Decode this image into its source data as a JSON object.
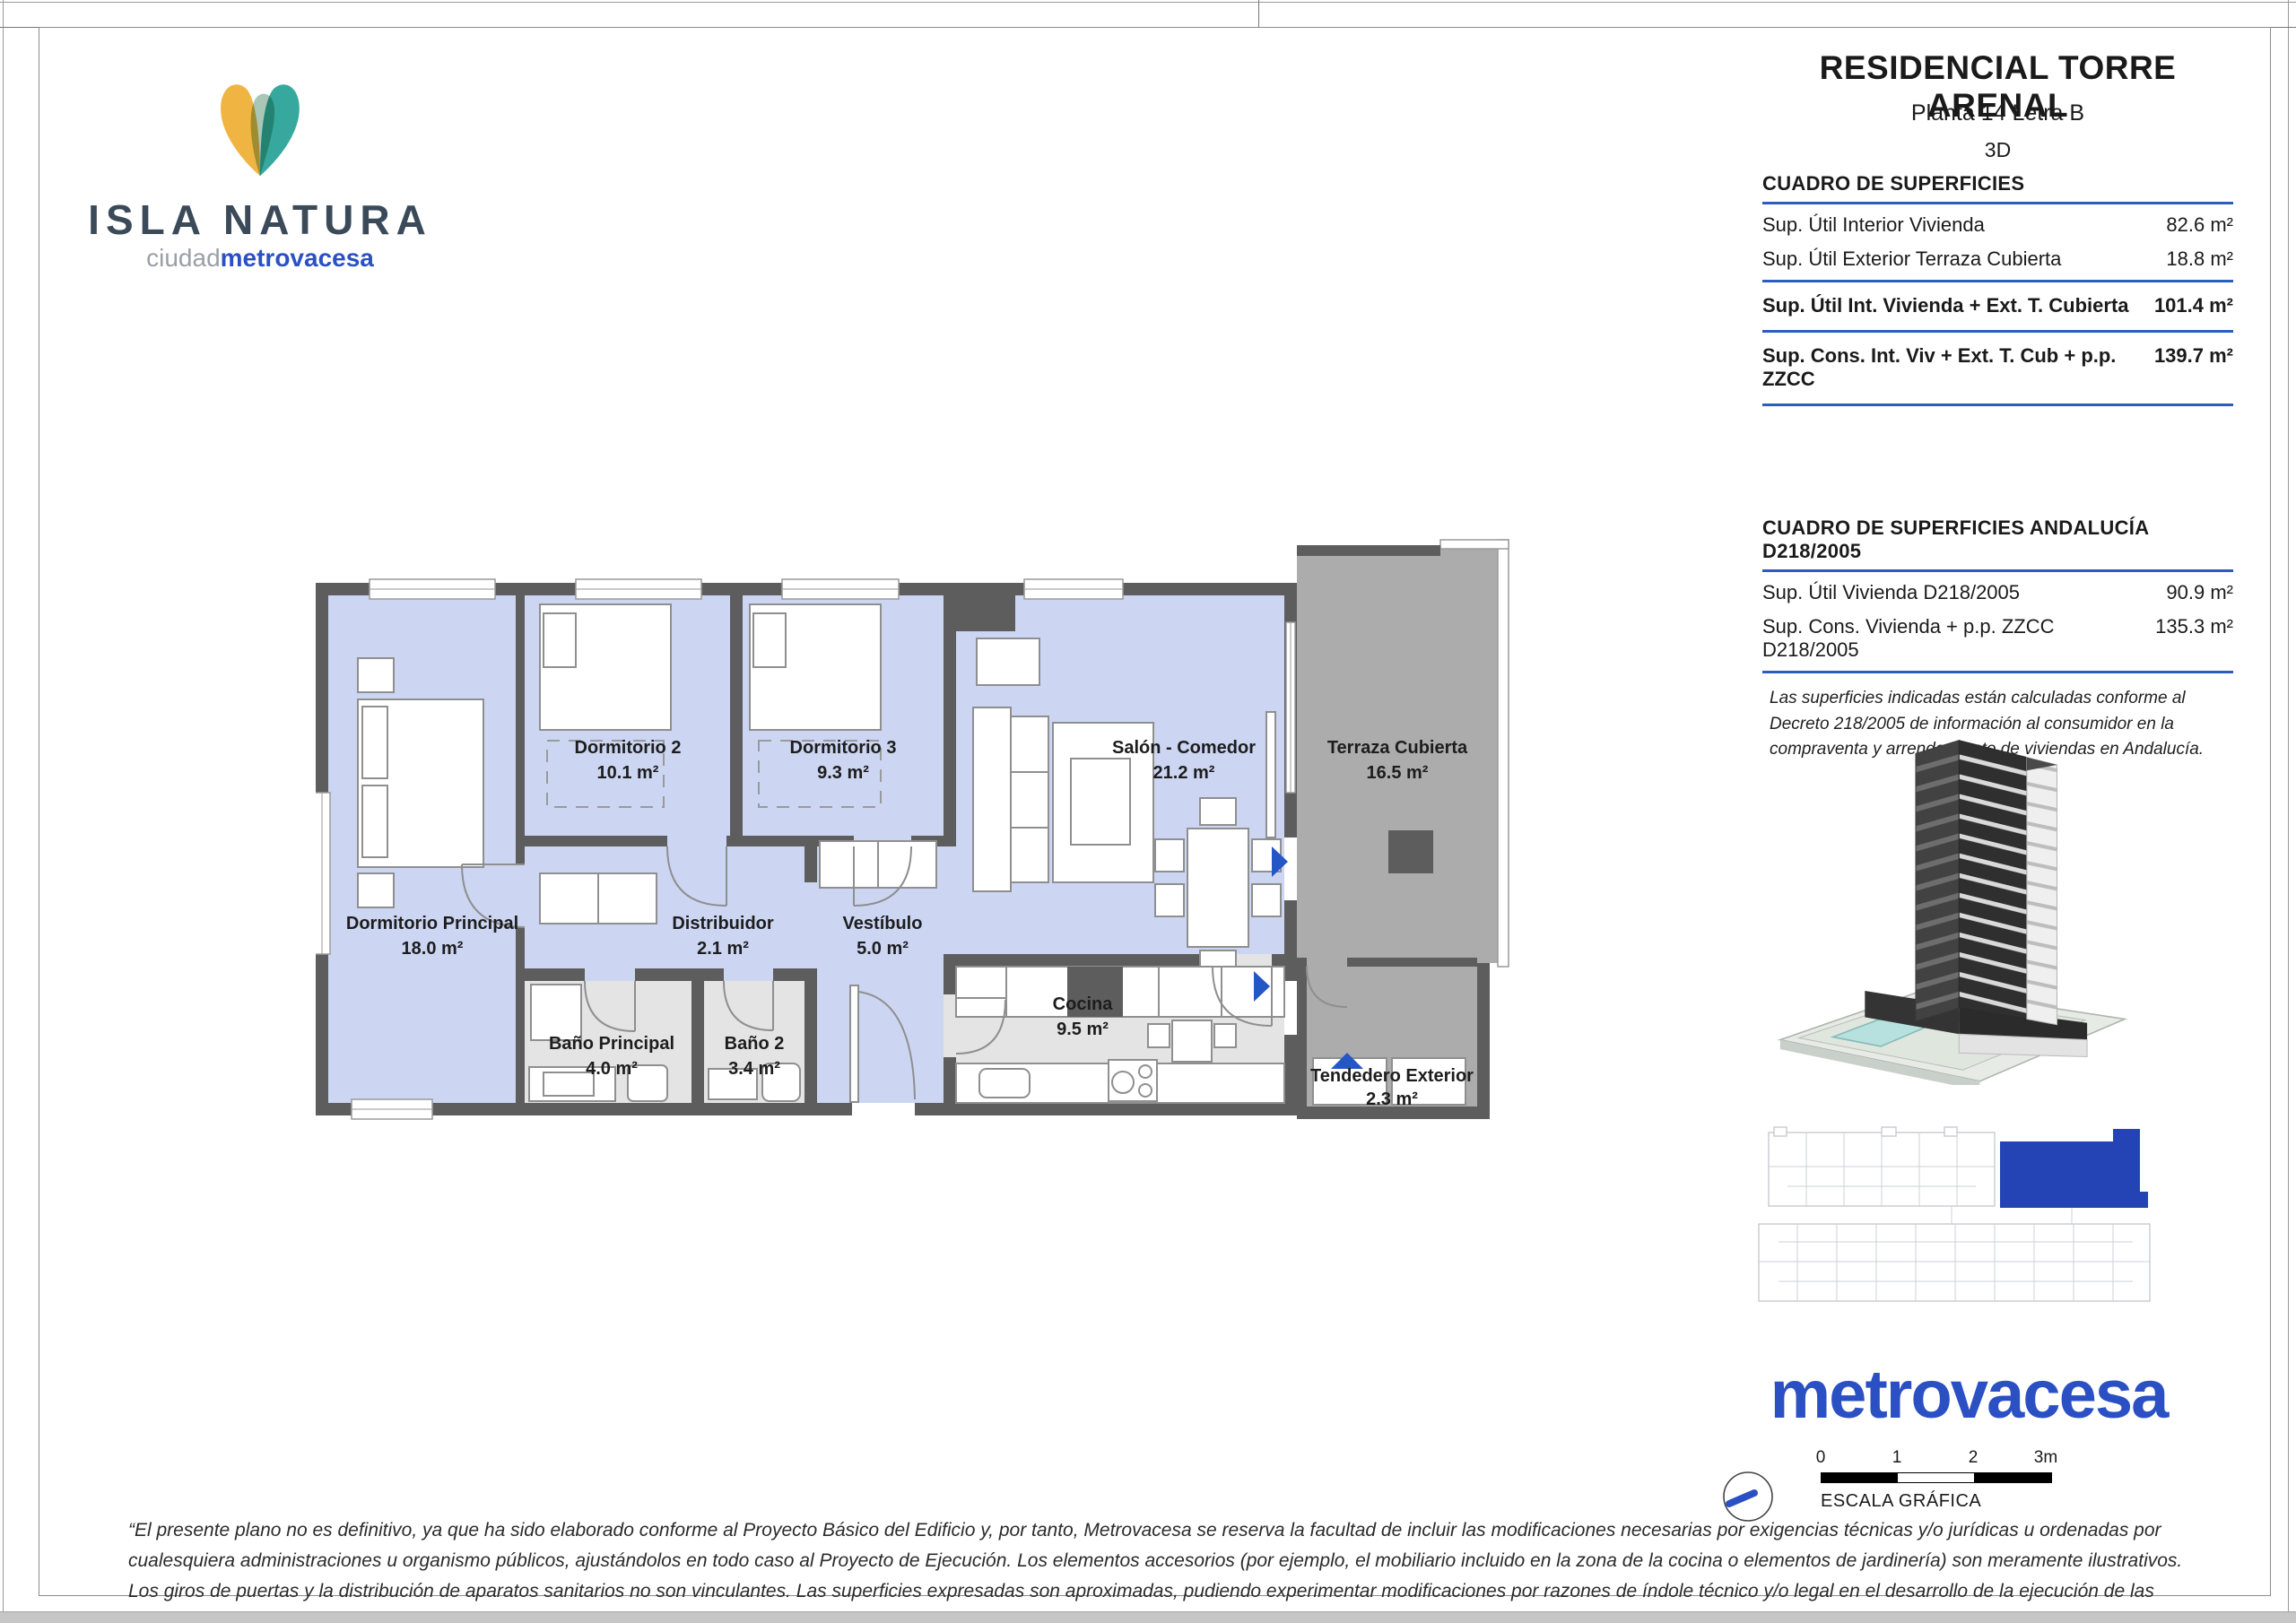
{
  "brand": {
    "name": "ISLA NATURA",
    "sub_gray": "ciudad",
    "sub_blue": "metrovacesa"
  },
  "header": {
    "project": "RESIDENCIAL TORRE ARENAL",
    "unit": "Planta 14 Letra B",
    "view": "3D"
  },
  "surfaces": {
    "title": "CUADRO DE SUPERFICIES",
    "rows": [
      {
        "label": "Sup. Útil Interior Vivienda",
        "value": "82.6 m²"
      },
      {
        "label": "Sup. Útil Exterior Terraza Cubierta",
        "value": "18.8 m²"
      },
      {
        "label": "Sup. Útil Int. Vivienda + Ext. T. Cubierta",
        "value": "101.4 m²"
      },
      {
        "label": "Sup. Cons. Int. Viv + Ext. T. Cub + p.p. ZZCC",
        "value": "139.7 m²"
      }
    ]
  },
  "andalucia": {
    "title": "CUADRO DE SUPERFICIES ANDALUCÍA D218/2005",
    "rows": [
      {
        "label": "Sup. Útil Vivienda D218/2005",
        "value": "90.9 m²"
      },
      {
        "label": "Sup. Cons. Vivienda + p.p. ZZCC D218/2005",
        "value": "135.3 m²"
      }
    ],
    "note": "Las superficies indicadas están calculadas conforme al Decreto 218/2005 de información al consumidor en la compraventa y arrendamiento de viviendas en Andalucía."
  },
  "rooms": [
    {
      "name": "Dormitorio 2",
      "area": "10.1 m²"
    },
    {
      "name": "Dormitorio 3",
      "area": "9.3 m²"
    },
    {
      "name": "Salón - Comedor",
      "area": "21.2 m²"
    },
    {
      "name": "Terraza Cubierta",
      "area": "16.5 m²"
    },
    {
      "name": "Dormitorio Principal",
      "area": "18.0 m²"
    },
    {
      "name": "Distribuidor",
      "area": "2.1 m²"
    },
    {
      "name": "Vestíbulo",
      "area": "5.0 m²"
    },
    {
      "name": "Baño Principal",
      "area": "4.0 m²"
    },
    {
      "name": "Baño 2",
      "area": "3.4 m²"
    },
    {
      "name": "Cocina",
      "area": "9.5 m²"
    },
    {
      "name": "Tendedero Exterior",
      "area": "2.3 m²"
    }
  ],
  "footer": {
    "logo": "metrovacesa",
    "scale_labels": [
      "0",
      "1",
      "2",
      "3m"
    ],
    "scale_caption": "ESCALA GRÁFICA",
    "disclaimer": "“El presente plano no es definitivo, ya que ha sido elaborado conforme al Proyecto Básico del Edificio y, por tanto, Metrovacesa se reserva la facultad de incluir las modificaciones necesarias por exigencias técnicas y/o jurídicas u ordenadas por cualesquiera administraciones u organismo públicos, ajustándolos en todo caso al Proyecto de Ejecución. Los elementos accesorios (por ejemplo, el mobiliario incluido en la zona de la cocina o elementos de jardinería) son meramente ilustrativos. Los giros de puertas y la distribución de aparatos sanitarios no son vinculantes. Las superficies expresadas son aproximadas, pudiendo experimentar modificaciones por razones de índole técnico y/o legal en el desarrollo de la ejecución de las obras.”"
  },
  "colors": {
    "accent_rule_blue": "#2c5cbf",
    "logo_blue": "#2b50c4",
    "brand_navy": "#3b4a59",
    "room_lavender": "#ccd6f3",
    "wall_gray": "#5d5d5d",
    "wet_room_gray": "#e4e4e4",
    "terrace_gray": "#acacac",
    "arrow_blue": "#2456c6",
    "keyplan_blue": "#2444b5",
    "heart_yellow": "#efb441",
    "heart_teal": "#36a89d",
    "heart_sage": "#a9c6b6"
  }
}
